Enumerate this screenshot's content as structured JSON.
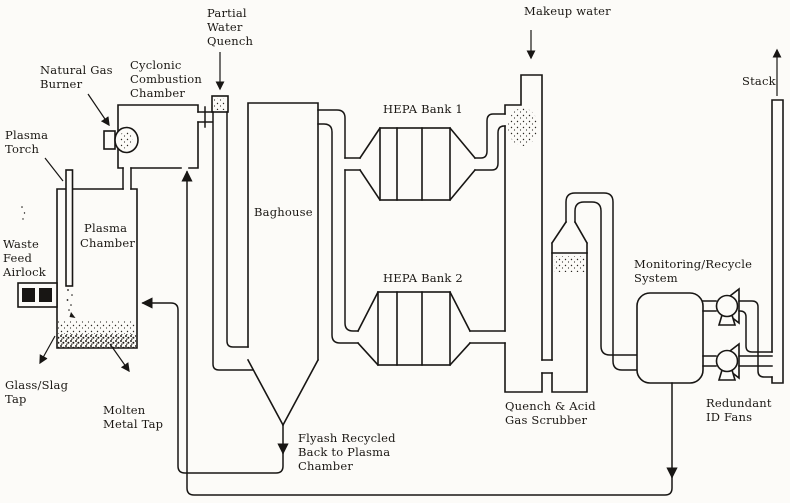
{
  "diagram": {
    "title": "Plasma waste treatment system process flow diagram",
    "colors": {
      "line": "#181614",
      "text": "#1b1814",
      "background": "#fcfbf8"
    },
    "labels": {
      "natural_gas_burner": [
        "Natural Gas",
        "Burner"
      ],
      "cyclonic_combustion_chamber": [
        "Cyclonic",
        "Combustion",
        "Chamber"
      ],
      "partial_water_quench": [
        "Partial",
        "Water",
        "Quench"
      ],
      "plasma_torch": [
        "Plasma",
        "Torch"
      ],
      "plasma_chamber": [
        "Plasma",
        "Chamber"
      ],
      "waste_feed_airlock": [
        "Waste",
        "Feed",
        "Airlock"
      ],
      "glass_slag_tap": [
        "Glass/Slag",
        "Tap"
      ],
      "molten_metal_tap": [
        "Molten",
        "Metal Tap"
      ],
      "baghouse": [
        "Baghouse"
      ],
      "hepa_bank_1": [
        "HEPA Bank 1"
      ],
      "hepa_bank_2": [
        "HEPA Bank 2"
      ],
      "makeup_water": [
        "Makeup water"
      ],
      "flyash_recycle": [
        "Flyash Recycled",
        "Back to Plasma",
        "Chamber"
      ],
      "quench_acid_gas_scrubber": [
        "Quench & Acid",
        "Gas Scrubber"
      ],
      "monitoring_recycle_system": [
        "Monitoring/Recycle",
        "System"
      ],
      "redundant_id_fans": [
        "Redundant",
        "ID Fans"
      ],
      "stack": [
        "Stack"
      ]
    }
  }
}
